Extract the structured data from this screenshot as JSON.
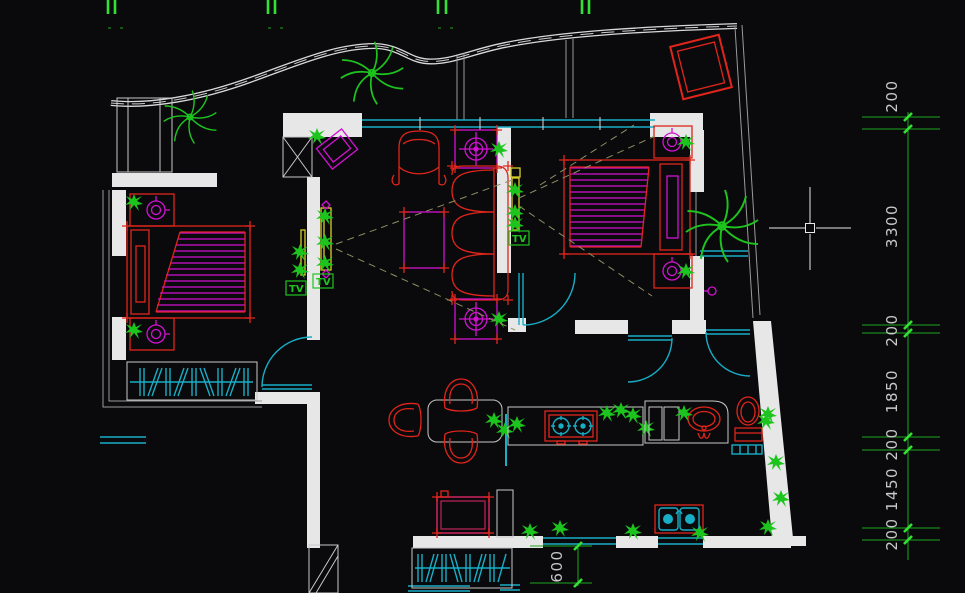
{
  "scene": {
    "name": "CAD apartment floor plan canvas",
    "background": "#0a0a0d"
  },
  "colors": {
    "walls": "#e7e7e7",
    "furniture_red": "#e0251b",
    "decor_magenta": "#d211d2",
    "fixtures_cyan": "#17aec6",
    "plants_green": "#1ec41e",
    "dimension_green": "#1fa51f",
    "tv_yellow": "#d9cf25",
    "appliance_crimson": "#c02458",
    "dimension_text": "#c9c9c9"
  },
  "dimensions": {
    "right_chain": [
      "200",
      "3300",
      "200",
      "1850",
      "200",
      "1450",
      "200"
    ],
    "bottom": "600"
  },
  "labels": {
    "tv_bedroom_left": "TV",
    "tv_living": "TV",
    "tv_bedroom_right": "TV"
  }
}
